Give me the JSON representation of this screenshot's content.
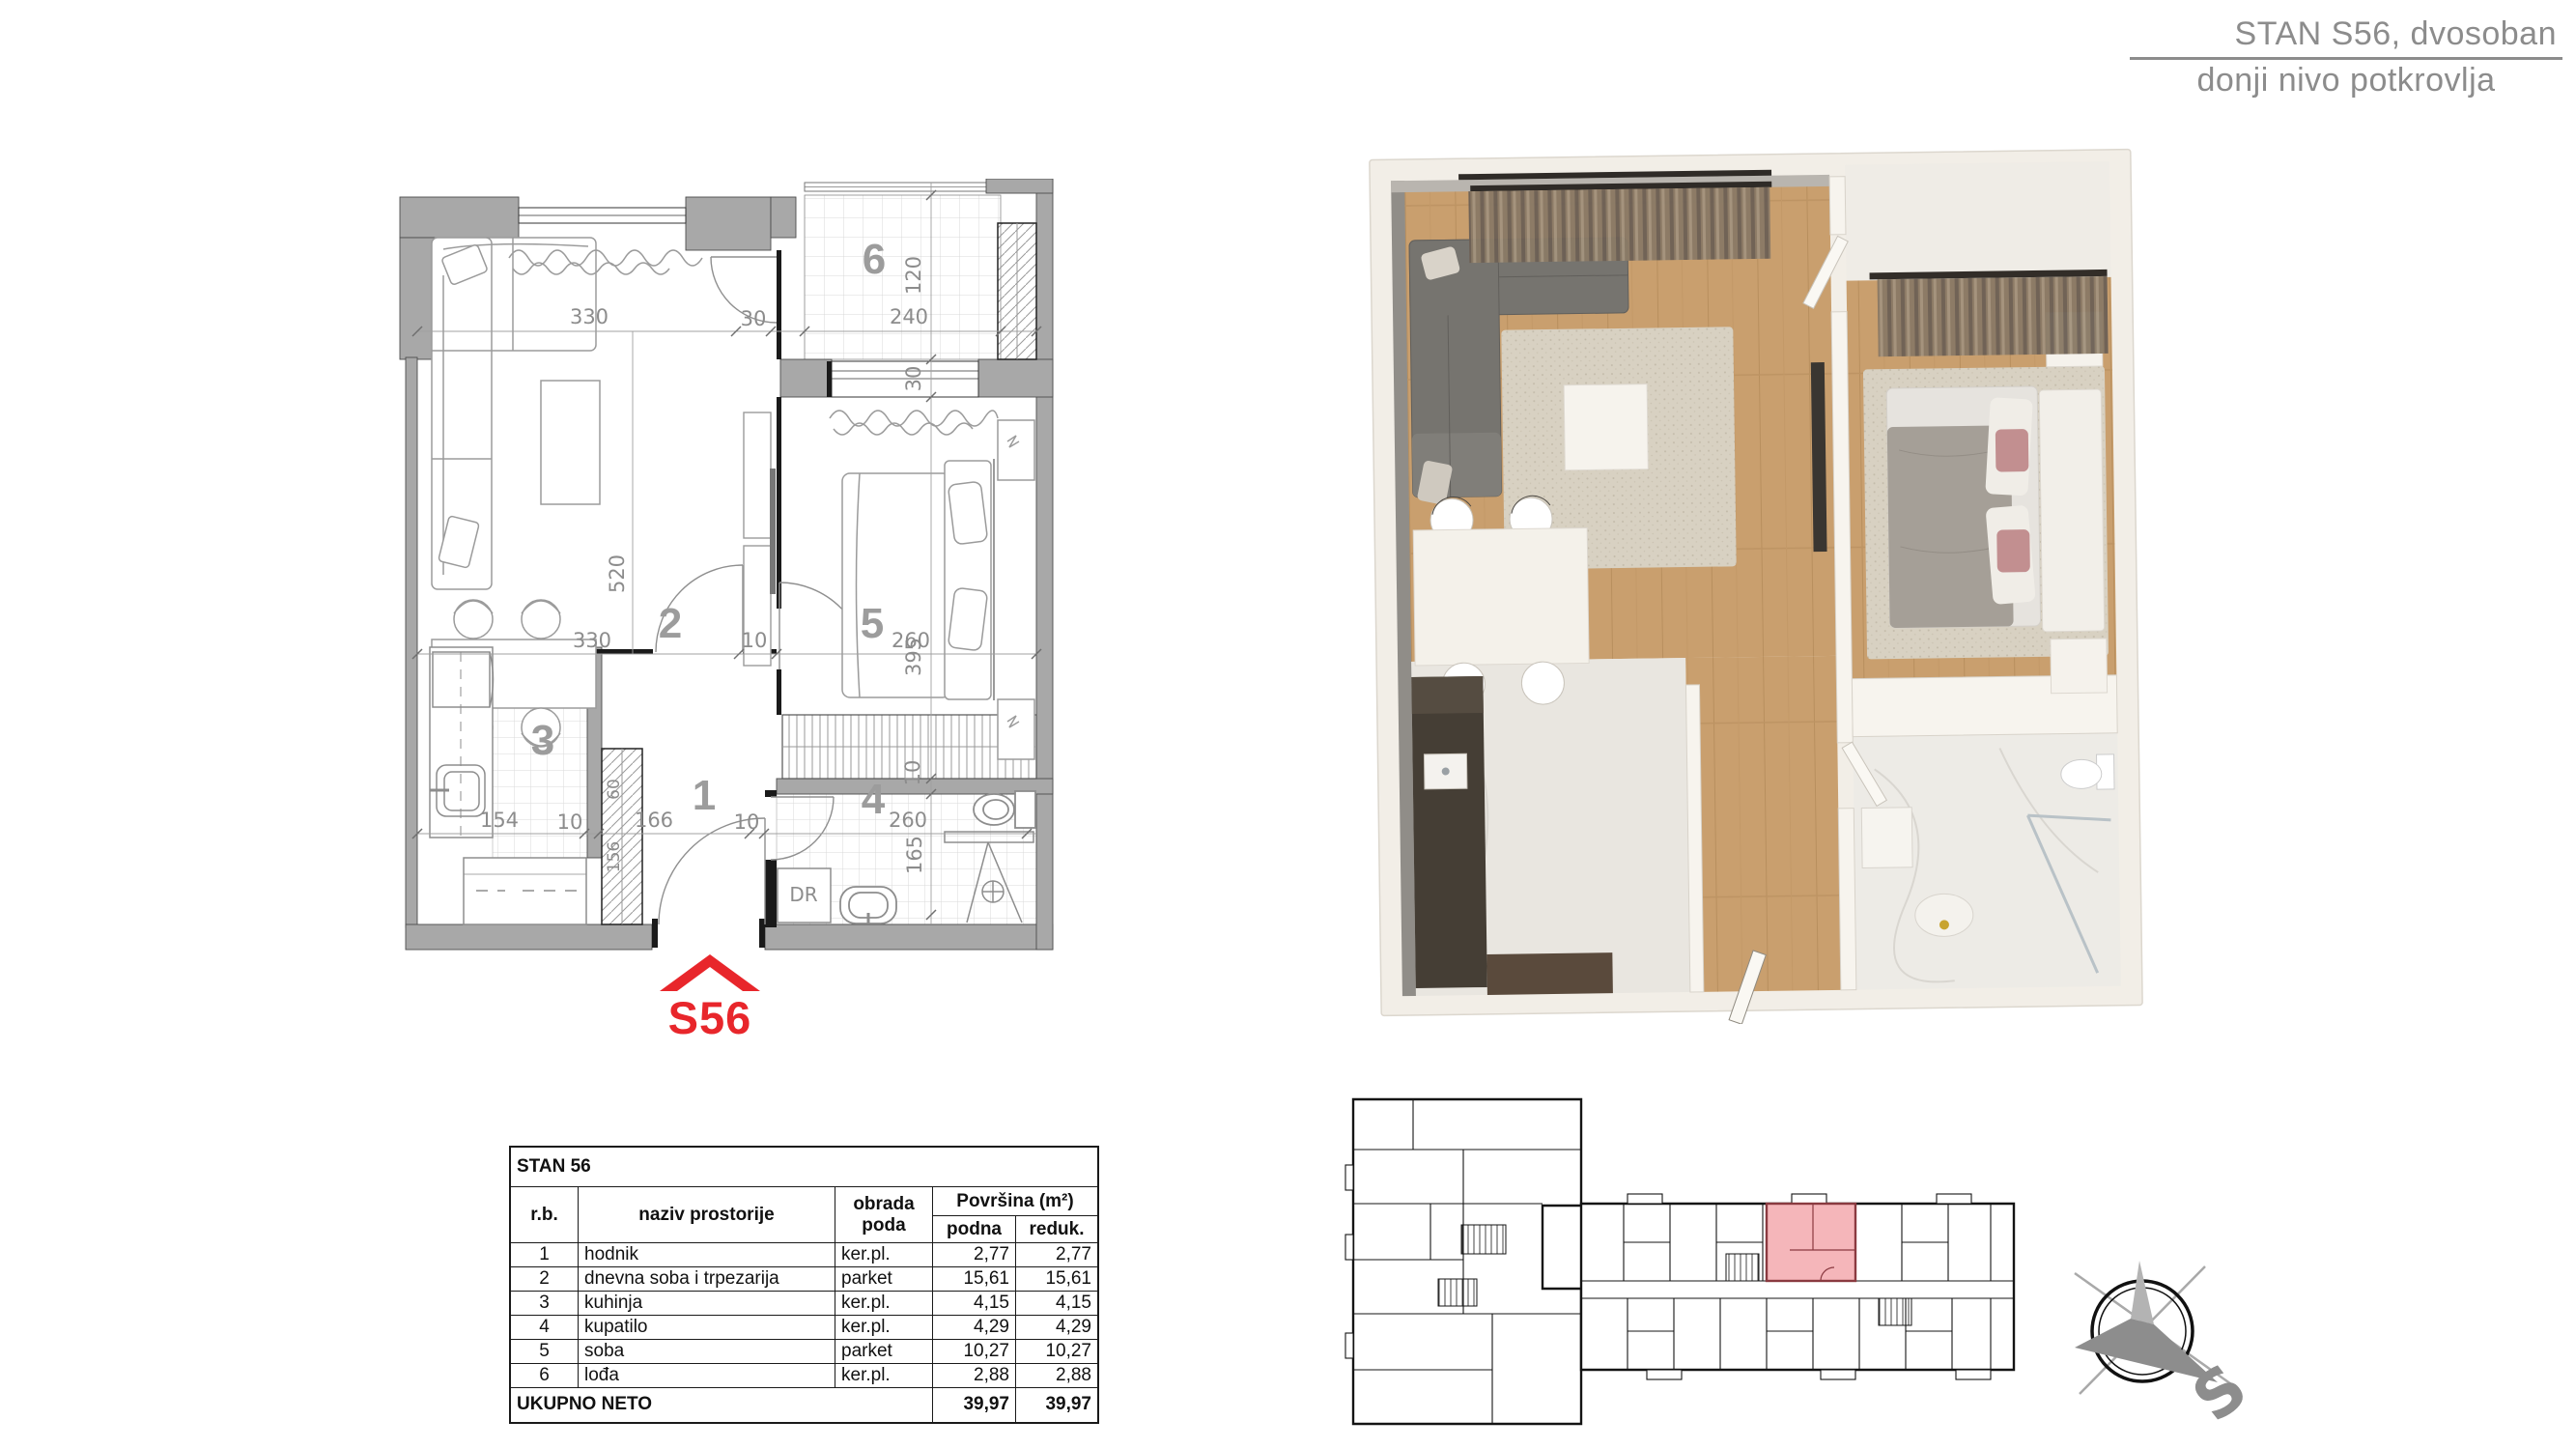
{
  "header": {
    "line1": "STAN S56, dvosoban",
    "line2": "donji nivo potkrovlja"
  },
  "plan": {
    "rooms": {
      "r1": "1",
      "r2": "2",
      "r3": "3",
      "r4": "4",
      "r5": "5",
      "r6": "6"
    },
    "dims": {
      "top_330": "330",
      "top_30": "30",
      "top_240": "240",
      "v_120": "120",
      "v_30": "30",
      "v_520": "520",
      "v_395": "395",
      "mid_330": "330",
      "mid_10": "10",
      "mid_260": "260",
      "bot_154": "154",
      "bot_10a": "10",
      "bot_166": "166",
      "bot_10b": "10",
      "bot_260": "260",
      "bath_10": "10",
      "bath_165": "165",
      "closet_60": "60",
      "closet_156": "156"
    },
    "labels": {
      "dr": "DR"
    },
    "logo": "S56"
  },
  "table": {
    "title": "STAN 56",
    "headers": {
      "rb": "r.b.",
      "naziv": "naziv  prostorije",
      "obrada": "obrada poda",
      "povrsina": "Površina (m²)",
      "podna": "podna",
      "reduk": "reduk."
    },
    "rows": [
      {
        "rb": "1",
        "naziv": "hodnik",
        "obrada": "ker.pl.",
        "podna": "2,77",
        "reduk": "2,77"
      },
      {
        "rb": "2",
        "naziv": "dnevna soba i trpezarija",
        "obrada": "parket",
        "podna": "15,61",
        "reduk": "15,61"
      },
      {
        "rb": "3",
        "naziv": "kuhinja",
        "obrada": "ker.pl.",
        "podna": "4,15",
        "reduk": "4,15"
      },
      {
        "rb": "4",
        "naziv": "kupatilo",
        "obrada": "ker.pl.",
        "podna": "4,29",
        "reduk": "4,29"
      },
      {
        "rb": "5",
        "naziv": "soba",
        "obrada": "parket",
        "podna": "10,27",
        "reduk": "10,27"
      },
      {
        "rb": "6",
        "naziv": "lođa",
        "obrada": "ker.pl.",
        "podna": "2,88",
        "reduk": "2,88"
      }
    ],
    "total": {
      "label": "UKUPNO NETO",
      "podna": "39,97",
      "reduk": "39,97"
    }
  },
  "compass": {
    "letter": "S"
  },
  "colors": {
    "accent_red": "#e8262b",
    "plan_gray": "#8c8c8c",
    "highlight_pink": "#f5b6ba"
  }
}
